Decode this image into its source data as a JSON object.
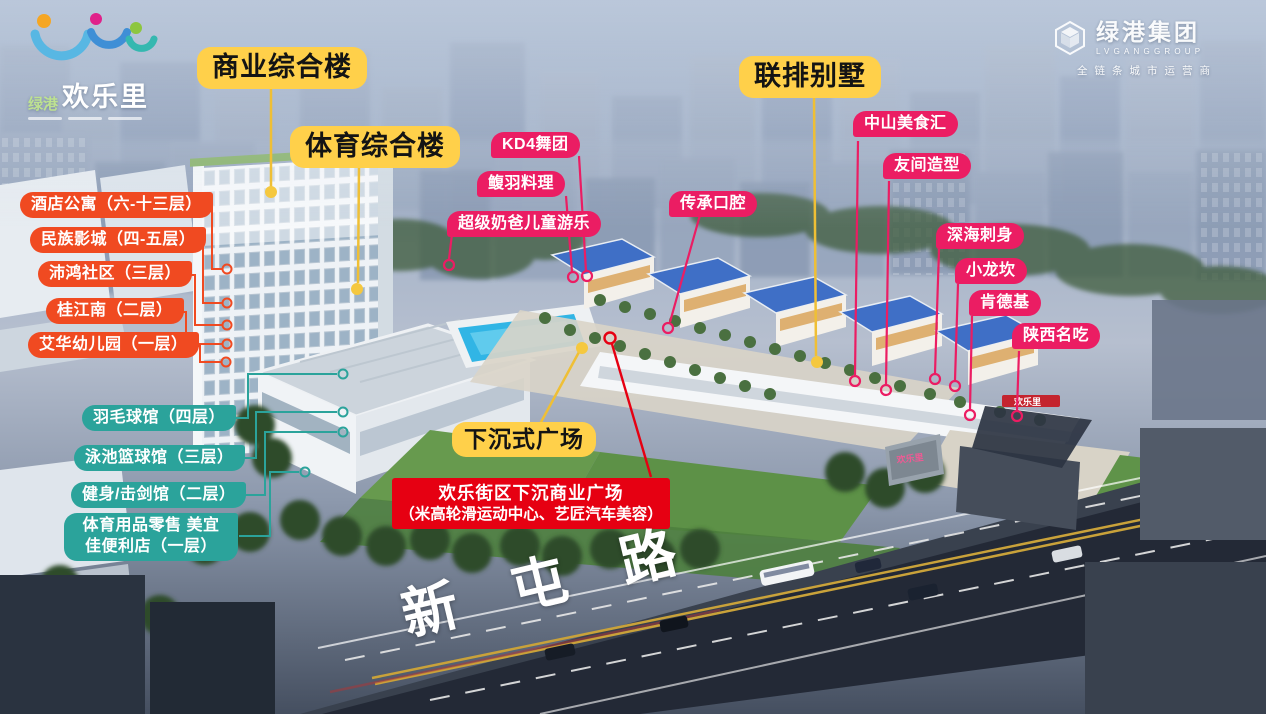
{
  "project": {
    "brand_prefix": "绿港",
    "brand_name": "欢乐里"
  },
  "logo_group": {
    "name": "绿港集团",
    "latin": "LVGANGGROUP",
    "tagline": "全链条城市运营商"
  },
  "labels": {
    "yellow": [
      "商业综合楼",
      "体育综合楼",
      "联排别墅",
      "下沉式广场"
    ],
    "orange": [
      "酒店公寓（六-十三层）",
      "民族影城（四-五层）",
      "沛鸿社区（三层）",
      "桂江南（二层）",
      "艾华幼儿园（一层）"
    ],
    "teal": [
      "羽毛球馆（四层）",
      "泳池篮球馆（三层）",
      "健身/击剑馆（二层）"
    ],
    "teal_two_line": {
      "line1": "体育用品零售",
      "line2": "美宜佳便利店（一层）"
    },
    "pink": [
      "KD4舞团",
      "鳆羽料理",
      "超级奶爸儿童游乐",
      "传承口腔",
      "中山美食汇",
      "友间造型",
      "深海刺身",
      "小龙坎",
      "肯德基",
      "陕西名吃"
    ]
  },
  "notice": {
    "line1": "欢乐街区下沉商业广场",
    "line2": "（米高轮滑运动中心、艺匠汽车美容）"
  },
  "road": {
    "name": "新屯路"
  },
  "scene": {
    "gate_sign": "欢乐里"
  },
  "colors": {
    "yellow_tag": "#FFD04A",
    "orange_tag": "#F04A21",
    "teal_tag": "#2BA39B",
    "pink_tag": "#EB1D63",
    "notice_red": "#E60012"
  }
}
